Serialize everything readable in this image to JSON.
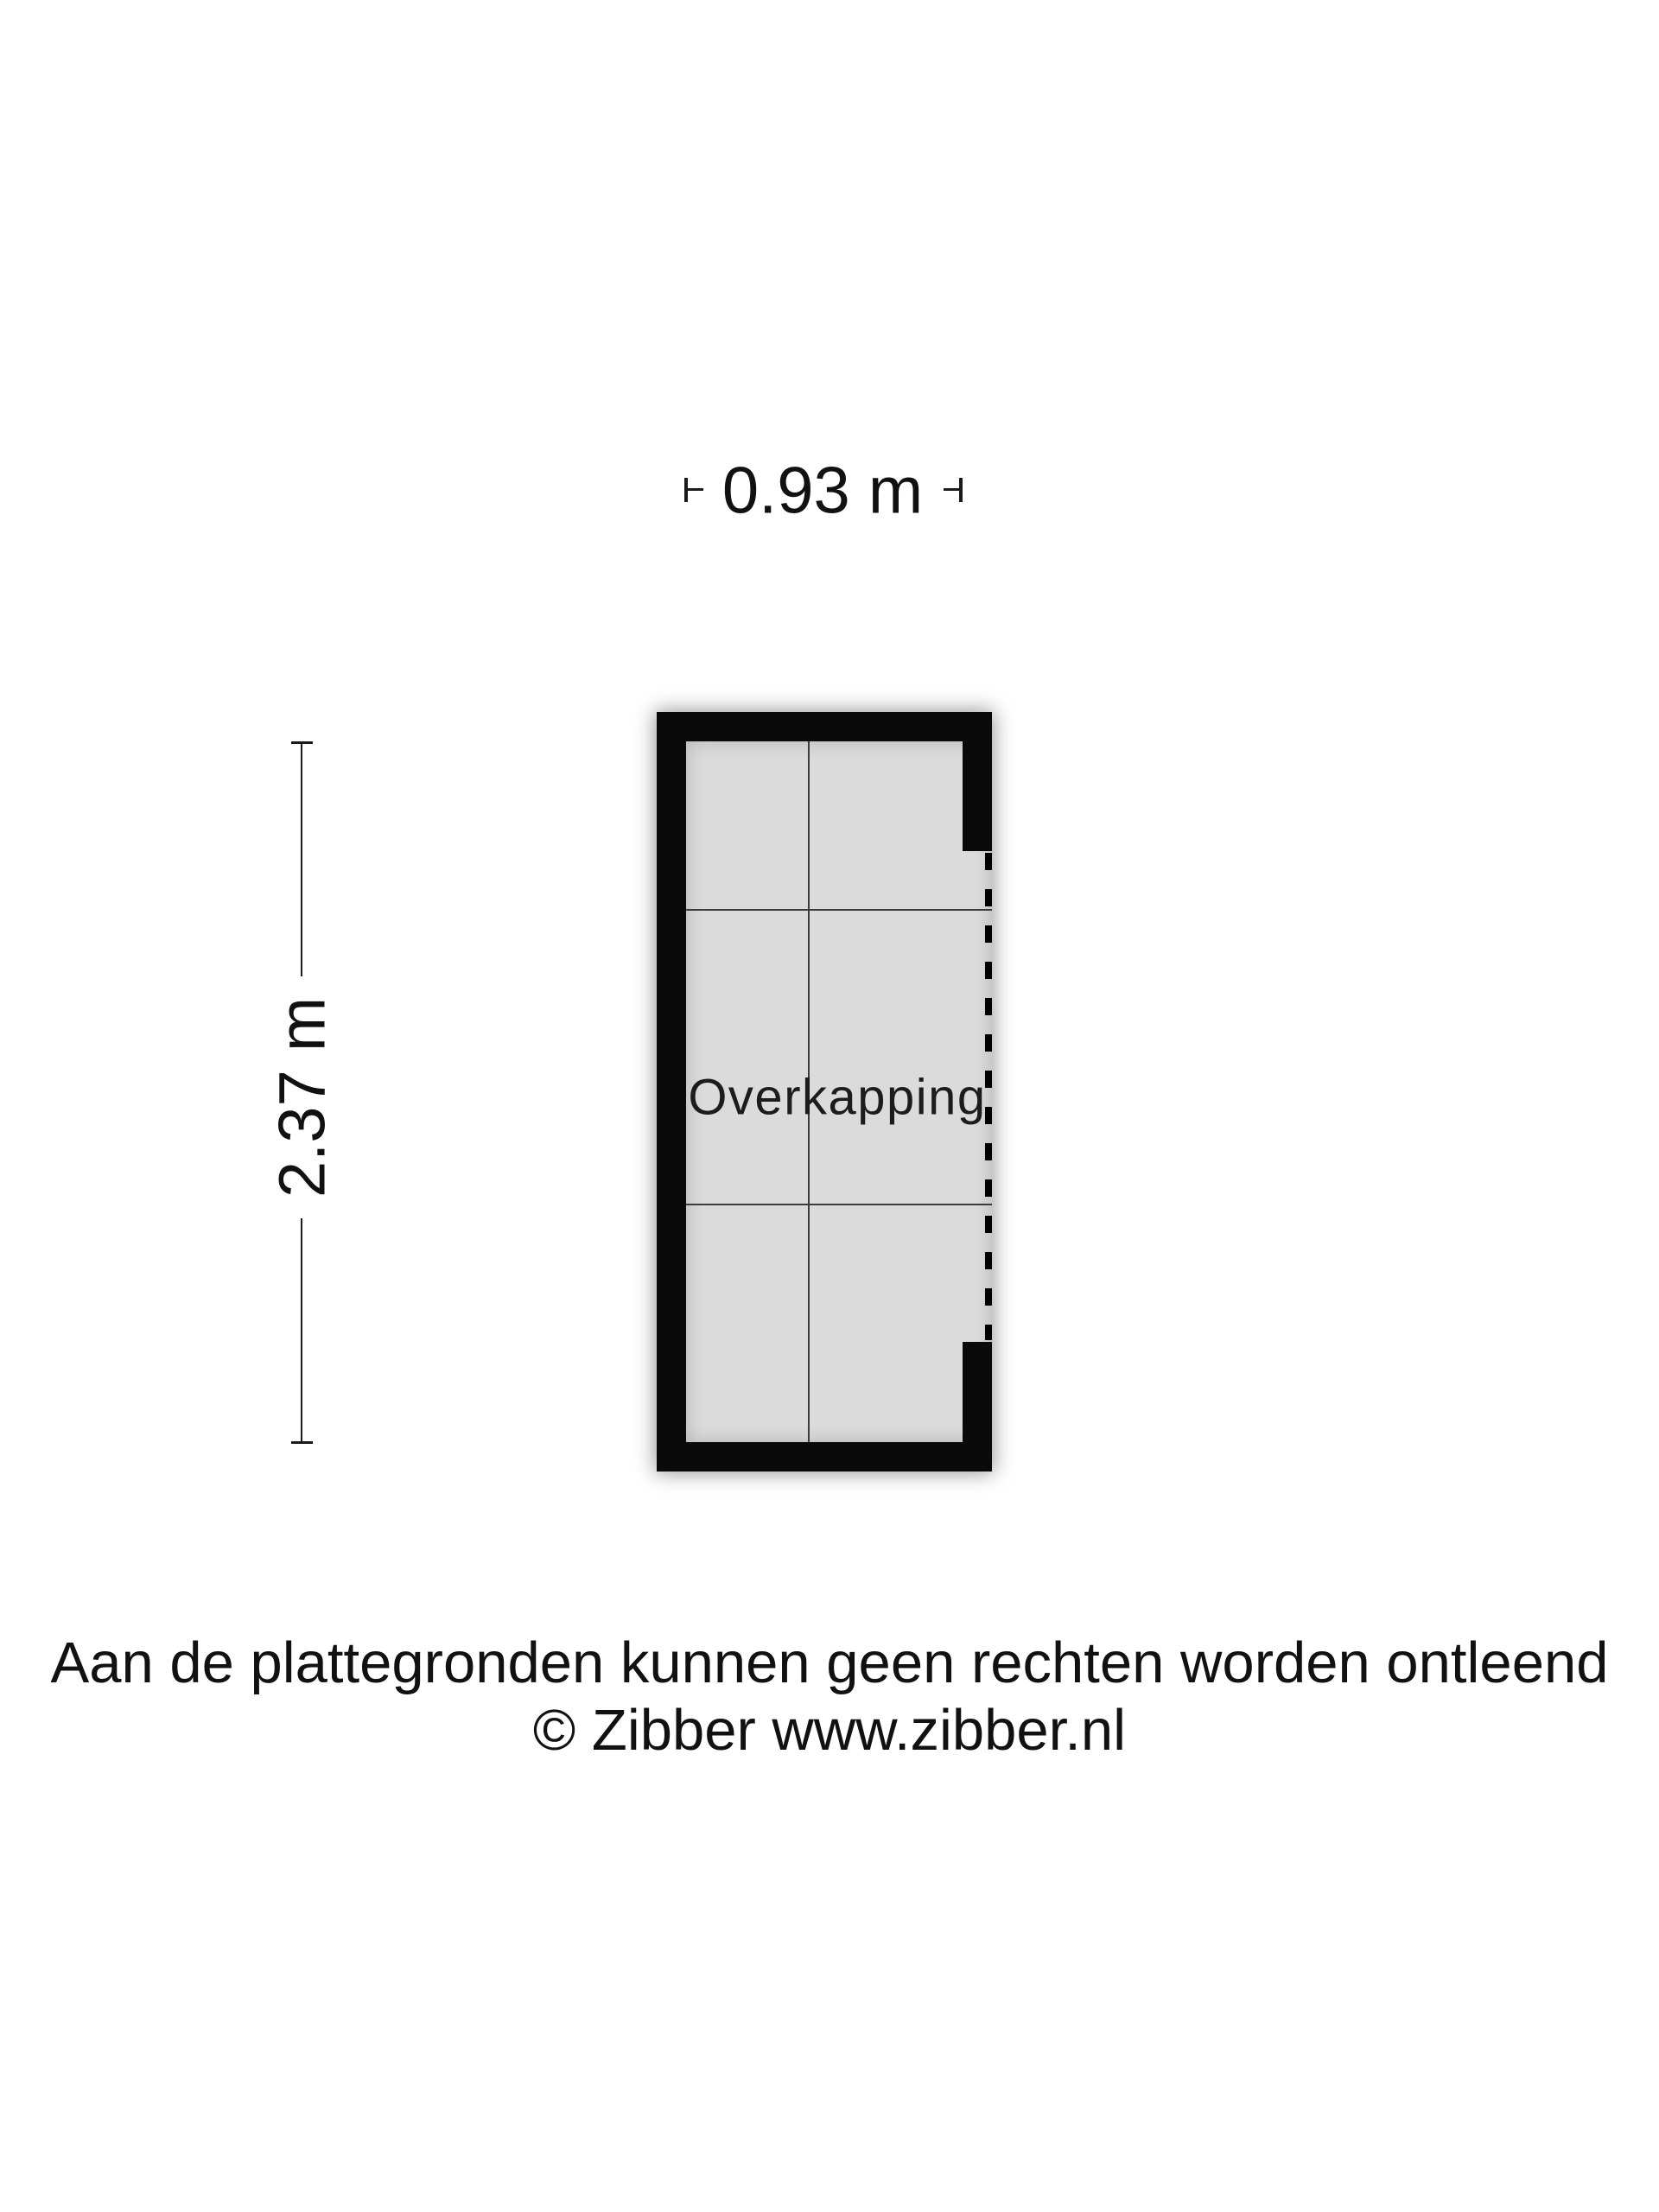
{
  "floor_plan": {
    "room_label": "Overkapping",
    "dimensions": {
      "width_label": "0.93 m",
      "height_label": "2.37 m"
    },
    "colors": {
      "wall": "#0a0a0a",
      "floor": "#dbdbdb",
      "grid_line": "#3c3c3c",
      "open_side_dash": "#000000",
      "background": "#ffffff",
      "text": "#1a1a1a"
    }
  },
  "footer": {
    "disclaimer": "Aan de plattegronden kunnen geen rechten worden ontleend",
    "copyright": "© Zibber www.zibber.nl"
  }
}
